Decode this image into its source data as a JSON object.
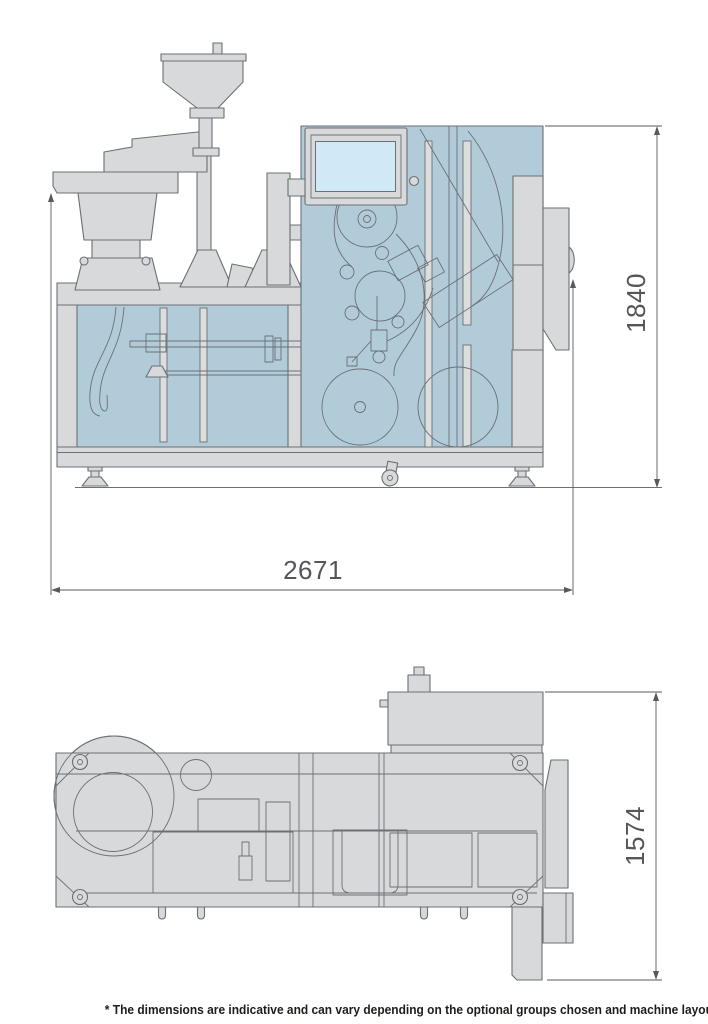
{
  "drawing": {
    "side_view": {
      "height_label": "1840",
      "width_label": "2671"
    },
    "plan_view": {
      "depth_label": "1574"
    },
    "footnote": "* The dimensions are indicative and can vary depending on the optional groups chosen and machine layout"
  },
  "colors": {
    "line": "#6b7075",
    "panel_gray": "#d8d9da",
    "panel_blue": "#b2cbd9",
    "screen_blue": "#cfe9f7",
    "slot_gray": "#dcdddd",
    "dim_line": "#58595b",
    "dim_text": "#54565a",
    "footnote_text": "#1d1d1b",
    "background": "#ffffff"
  }
}
